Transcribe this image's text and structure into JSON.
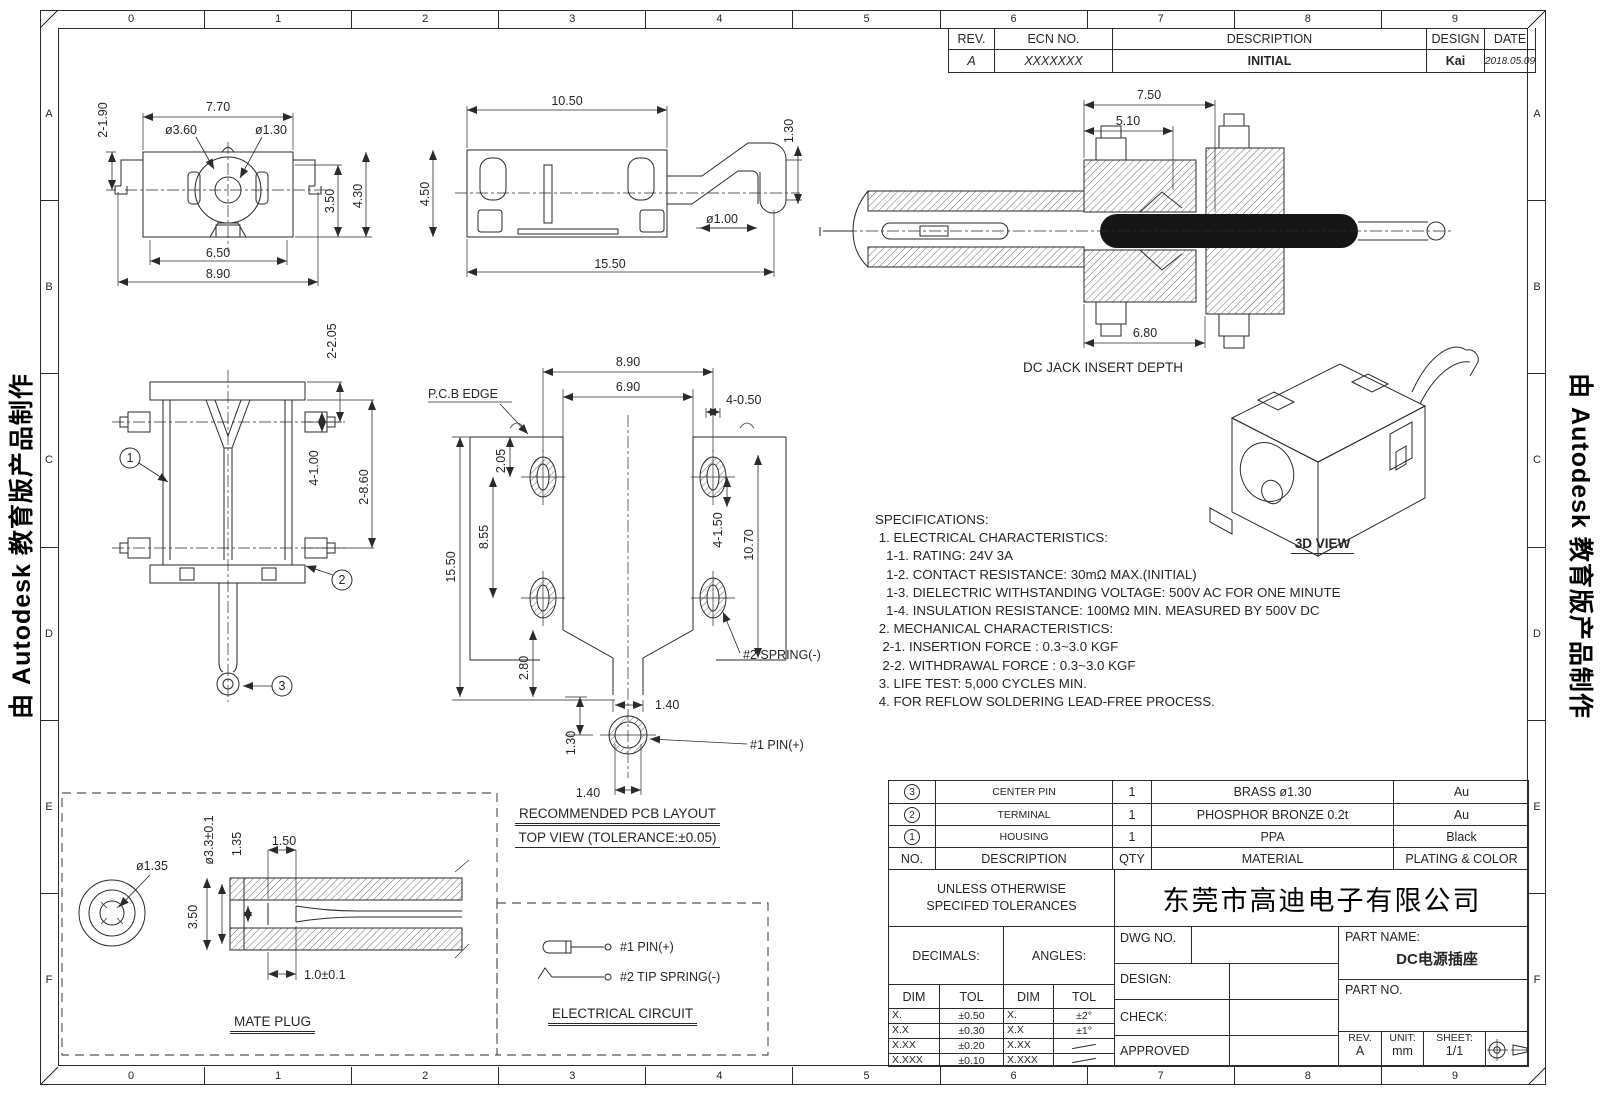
{
  "border": {
    "columns": [
      "0",
      "1",
      "2",
      "3",
      "4",
      "5",
      "6",
      "7",
      "8",
      "9"
    ],
    "rows": [
      "A",
      "B",
      "C",
      "D",
      "E",
      "F"
    ]
  },
  "watermark": {
    "text": "由 Autodesk 教育版产品制作"
  },
  "rev_table": {
    "headers": {
      "rev": "REV.",
      "ecn": "ECN NO.",
      "desc": "DESCRIPTION",
      "design": "DESIGN",
      "date": "DATE"
    },
    "row": {
      "rev": "A",
      "ecn": "XXXXXXX",
      "desc": "INITIAL",
      "design": "Kai",
      "date": "2018.05.09"
    }
  },
  "views": {
    "front": {
      "dims": {
        "w_top": "7.70",
        "legs": "2-1.90",
        "d_outer": "ø3.60",
        "d_inner": "ø1.30",
        "h_inner": "3.50",
        "h_total": "4.30",
        "w_inner": "6.50",
        "w_total": "8.90"
      }
    },
    "side": {
      "dims": {
        "w_top": "10.50",
        "h": "4.50",
        "len": "15.50",
        "pin_d": "ø1.00",
        "pin_h": "1.30"
      }
    },
    "section": {
      "dims": {
        "d1": "7.50",
        "d2": "5.10",
        "d3": "6.80"
      },
      "caption": "DC JACK INSERT DEPTH"
    },
    "top": {
      "dims": {
        "a": "2-2.05",
        "b": "4-1.00",
        "c": "2-8.60"
      },
      "balloons": [
        "1",
        "2",
        "3"
      ]
    },
    "pcb": {
      "dims": {
        "w_pads": "8.90",
        "w_inner": "6.90",
        "pad_w": "4-0.50",
        "top_off": "2.05",
        "pitch": "8.55",
        "len": "15.50",
        "slot": "4-1.50",
        "span": "10.70",
        "funnel": "2.80",
        "slot_w": "1.40",
        "pin_off": "1.30",
        "pin_w": "1.40"
      },
      "labels": {
        "pcb_edge": "P.C.B EDGE",
        "spring": "#2 SPRING(-)",
        "pin": "#1 PIN(+)"
      },
      "caption1": "RECOMMENDED PCB LAYOUT",
      "caption2": "TOP VIEW (TOLERANCE:±0.05)"
    },
    "mate": {
      "dims": {
        "tip_d": "ø1.35",
        "outer_d": "ø3.3±0.1",
        "inner_h": "1.35",
        "recess": "1.50",
        "dia": "3.50",
        "depth": "1.0±0.1"
      },
      "caption": "MATE PLUG"
    },
    "circuit": {
      "pin": "#1 PIN(+)",
      "spring": "#2 TIP SPRING(-)",
      "caption": "ELECTRICAL CIRCUIT"
    },
    "iso": {
      "caption": "3D VIEW"
    }
  },
  "specs": {
    "lines": [
      "SPECIFICATIONS:",
      " 1. ELECTRICAL CHARACTERISTICS:",
      "   1-1. RATING: 24V 3A",
      "   1-2. CONTACT RESISTANCE: 30mΩ MAX.(INITIAL)",
      "   1-3. DIELECTRIC WITHSTANDING VOLTAGE: 500V AC FOR ONE MINUTE",
      "   1-4. INSULATION RESISTANCE: 100MΩ MIN. MEASURED BY 500V DC",
      " 2. MECHANICAL CHARACTERISTICS:",
      "  2-1. INSERTION FORCE : 0.3~3.0 KGF",
      "  2-2. WITHDRAWAL FORCE : 0.3~3.0 KGF",
      " 3. LIFE TEST: 5,000 CYCLES MIN.",
      " 4. FOR REFLOW SOLDERING LEAD-FREE PROCESS."
    ]
  },
  "bom": {
    "headers": {
      "no": "NO.",
      "desc": "DESCRIPTION",
      "qty": "QTY",
      "mat": "MATERIAL",
      "plating": "PLATING & COLOR"
    },
    "rows": [
      {
        "no": "3",
        "desc": "CENTER PIN",
        "qty": "1",
        "mat": "BRASS ø1.30",
        "plating": "Au"
      },
      {
        "no": "2",
        "desc": "TERMINAL",
        "qty": "1",
        "mat": "PHOSPHOR BRONZE 0.2t",
        "plating": "Au"
      },
      {
        "no": "1",
        "desc": "HOUSING",
        "qty": "1",
        "mat": "PPA",
        "plating": "Black"
      }
    ]
  },
  "title_block": {
    "note1": "UNLESS OTHERWISE",
    "note2": "SPECIFED TOLERANCES",
    "company": "东莞市高迪电子有限公司",
    "decimals_label": "DECIMALS:",
    "angles_label": "ANGLES:",
    "dim": "DIM",
    "tol": "TOL",
    "decimals": [
      {
        "dim": "X.",
        "tol": "±0.50"
      },
      {
        "dim": "X.X",
        "tol": "±0.30"
      },
      {
        "dim": "X.XX",
        "tol": "±0.20"
      },
      {
        "dim": "X.XXX",
        "tol": "±0.10"
      }
    ],
    "angles": [
      {
        "dim": "X.",
        "tol": "±2°"
      },
      {
        "dim": "X.X",
        "tol": "±1°"
      },
      {
        "dim": "X.XX",
        "tol": ""
      },
      {
        "dim": "X.XXX",
        "tol": ""
      }
    ],
    "dwg_no": "DWG NO.",
    "design": "DESIGN:",
    "check": "CHECK:",
    "approved": "APPROVED",
    "part_name": "PART NAME:",
    "part_name_value": "DC电源插座",
    "part_no": "PART NO.",
    "rev": "REV.",
    "rev_value": "A",
    "unit": "UNIT:",
    "unit_value": "mm",
    "sheet": "SHEET:",
    "sheet_value": "1/1"
  }
}
